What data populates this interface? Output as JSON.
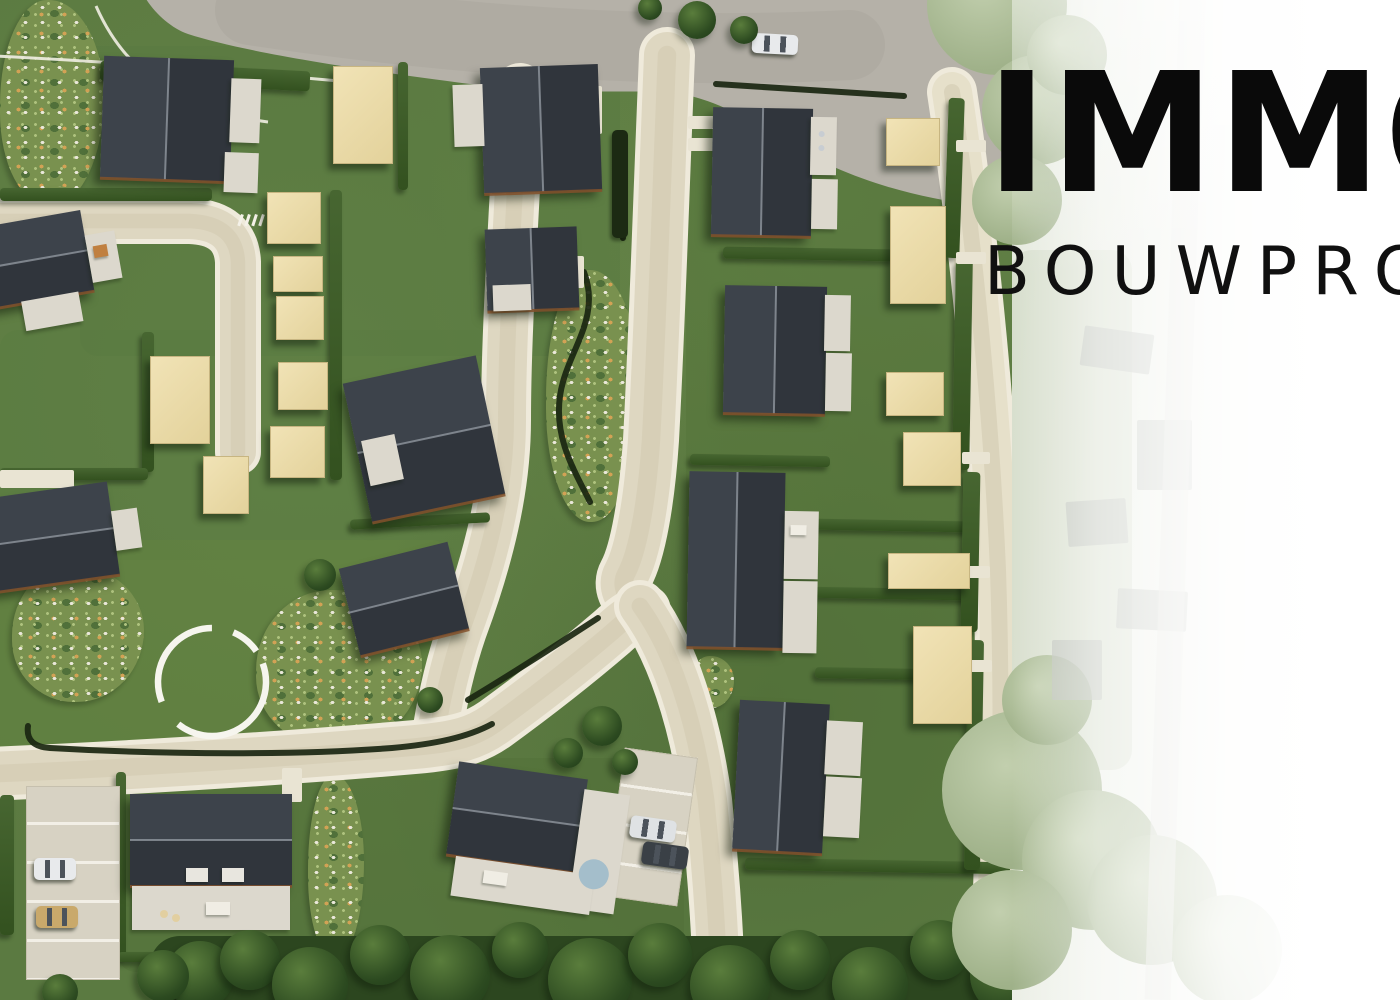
{
  "meta": {
    "description": "Aerial 3D masterplan render of a new-build housing development with roads, lawns, hedges, garages and a park, fading on the right into an aerial photo with the developer logo",
    "developer_logo_visible": true
  },
  "logo": {
    "line1_visible": "IMM",
    "line1_clipped_letter": "O",
    "line2_visible": "BOUWPR",
    "line2_clipped_letter": "O",
    "color": "#0a0a0a"
  },
  "palette": {
    "grass": "#5b7a41",
    "road_asphalt": "#b5b1a8",
    "road_beige": "#ded7c1",
    "road_edge": "#efeadb",
    "roof_dark_a": "#3d434b",
    "roof_dark_b": "#30353c",
    "facade_white": "#dcd8cd",
    "garage_beige": "#ecdcab",
    "hedge_green": "#3b5a2b",
    "hedge_dark": "#1c2a13",
    "forest": "#2c461f",
    "path_circle_white": "#f6f5ee",
    "spa_blue": "#a4becb",
    "fade_white": "#ffffff"
  },
  "scene": {
    "patches": [
      {
        "x": 80,
        "y": 46,
        "w": 540,
        "h": 310,
        "c": "#587740",
        "o": 0.4
      },
      {
        "x": 0,
        "y": 330,
        "w": 500,
        "h": 230,
        "c": "#5a7a42",
        "o": 0.35
      },
      {
        "x": 0,
        "y": 540,
        "w": 450,
        "h": 240,
        "c": "#64833f",
        "o": 0.5
      },
      {
        "x": 686,
        "y": 96,
        "w": 284,
        "h": 780,
        "c": "#55733a",
        "o": 0.45
      },
      {
        "x": 118,
        "y": 758,
        "w": 566,
        "h": 214,
        "c": "#4f6d38",
        "o": 0.4
      }
    ],
    "roads": {
      "top_fill": "M 140,-12 L 1014,-12 L 1014,205 C 985,207 958,203 933,198 C 878,187 828,168 783,140 C 743,115 704,94 664,92 C 629,90 560,95 470,84 C 330,66 238,50 188,34 C 168,27 149,8 140,-12 Z",
      "strokes": [
        {
          "n": "right-access-path",
          "d": "M 952,92 C 976,250 992,430 998,570 C 1003,720 1000,860 994,1005",
          "w": 40,
          "c": "#e6e0ca"
        },
        {
          "n": "cul-de-sac-west",
          "d": "M -12,221 L 190,221 Q 236,223 238,262 L 238,452",
          "w": 36,
          "c": "#ded7c1"
        },
        {
          "n": "street-north-south-west",
          "d": "M 520,88 C 514,220 506,330 506,420 C 506,490 488,560 462,630 C 450,665 442,700 436,740",
          "w": 40,
          "c": "#ded7c1"
        },
        {
          "n": "street-north-south-east",
          "d": "M 667,55 C 661,200 657,330 651,440 C 647,500 638,552 626,574 C 620,585 626,598 638,608",
          "w": 46,
          "c": "#ded7c1"
        },
        {
          "n": "loop-street",
          "d": "M -12,774 C 150,767 300,757 415,747 C 458,743 475,738 495,724 C 528,700 570,668 612,632 C 624,621 632,615 644,611",
          "w": 44,
          "c": "#ded7c1"
        },
        {
          "n": "street-southeast",
          "d": "M 640,606 C 672,650 695,720 706,800 C 713,865 718,935 720,1006",
          "w": 42,
          "c": "#ded7c1"
        }
      ],
      "dark_lines": [
        "M 28,726 C 26,740 34,747 50,748 C 170,755 300,755 392,748 C 436,744 468,737 492,724",
        "M 468,700 C 515,672 558,644 598,618",
        "M 584,272 C 602,320 566,352 560,396 C 554,438 574,470 590,502",
        "M 716,84 C 775,88 845,92 904,96",
        "M 619,134 L 623,238"
      ],
      "sidewalks": [
        "M -5,56 C 120,62 240,72 350,82",
        "M 96,6 C 118,56 152,86 200,104 C 228,114 252,120 268,122"
      ],
      "crosswalk": {
        "x": 241,
        "y": 214,
        "count": 4,
        "dx": 7
      }
    },
    "park_circle": {
      "cx": 212,
      "cy": 682,
      "r": 54,
      "dash": "140 28 105 22 30 14"
    },
    "houses": [
      {
        "n": "house-nw",
        "x": 102,
        "y": 58,
        "w": 130,
        "h": 122,
        "rot": 2,
        "split": "v",
        "parts": [
          [
            128,
            18,
            30,
            64
          ],
          [
            124,
            92,
            34,
            40
          ]
        ],
        "details": []
      },
      {
        "n": "house-n-mid",
        "x": 482,
        "y": 66,
        "w": 118,
        "h": 126,
        "rot": -2,
        "split": "v",
        "parts": [
          [
            -28,
            16,
            30,
            62
          ]
        ],
        "details": []
      },
      {
        "n": "house-small-mid",
        "x": 486,
        "y": 228,
        "w": 92,
        "h": 82,
        "rot": -2,
        "split": "v",
        "parts": [
          [
            6,
            56,
            38,
            26
          ]
        ],
        "details": []
      },
      {
        "n": "house-west-edge-1",
        "x": -12,
        "y": 218,
        "w": 100,
        "h": 82,
        "rot": -10,
        "split": "h",
        "parts": [
          [
            100,
            26,
            30,
            48
          ],
          [
            26,
            80,
            58,
            30
          ]
        ],
        "details": [
          {
            "t": "rect",
            "x": 106,
            "y": 38,
            "w": 14,
            "h": 12,
            "c": "#c08040"
          }
        ]
      },
      {
        "n": "house-west-edge-2",
        "x": -14,
        "y": 490,
        "w": 128,
        "h": 94,
        "rot": -8,
        "split": "h",
        "parts": [
          [
            128,
            30,
            26,
            40
          ]
        ],
        "details": []
      },
      {
        "n": "house-center",
        "x": 356,
        "y": 368,
        "w": 136,
        "h": 142,
        "rot": -12,
        "split": "h",
        "parts": [
          [
            6,
            60,
            34,
            46
          ]
        ],
        "details": []
      },
      {
        "n": "house-park",
        "x": 348,
        "y": 554,
        "w": 112,
        "h": 90,
        "rot": -14,
        "split": "h",
        "parts": [],
        "details": []
      },
      {
        "n": "house-sw-semi",
        "x": 130,
        "y": 794,
        "w": 162,
        "h": 92,
        "rot": 0,
        "split": "h",
        "parts": [
          [
            2,
            92,
            158,
            44
          ]
        ],
        "details": [
          {
            "t": "rect",
            "x": 56,
            "y": 74,
            "w": 22,
            "h": 14,
            "c": "#e8e6df"
          },
          {
            "t": "rect",
            "x": 92,
            "y": 74,
            "w": 22,
            "h": 14,
            "c": "#e8e6df"
          },
          {
            "t": "rect",
            "x": 76,
            "y": 108,
            "w": 24,
            "h": 13,
            "c": "#f0ede4"
          },
          {
            "t": "circle",
            "x": 30,
            "y": 116,
            "d": 8,
            "c": "#e2cfa0"
          },
          {
            "t": "circle",
            "x": 42,
            "y": 120,
            "d": 8,
            "c": "#e2cfa0"
          }
        ]
      },
      {
        "n": "house-s-semi",
        "x": 452,
        "y": 770,
        "w": 130,
        "h": 94,
        "rot": 8,
        "split": "h",
        "parts": [
          [
            128,
            10,
            46,
            120
          ],
          [
            10,
            94,
            140,
            40
          ]
        ],
        "details": [
          {
            "t": "circle",
            "x": 134,
            "y": 78,
            "d": 30,
            "c": "#a4becb"
          },
          {
            "t": "rect",
            "x": 40,
            "y": 104,
            "w": 24,
            "h": 13,
            "c": "#f0ede4"
          }
        ]
      },
      {
        "n": "house-e1",
        "x": 712,
        "y": 108,
        "w": 100,
        "h": 128,
        "rot": 1,
        "split": "v",
        "parts": [
          [
            98,
            8,
            26,
            58
          ],
          [
            100,
            70,
            26,
            50
          ]
        ],
        "details": [
          {
            "t": "circle",
            "x": 106,
            "y": 22,
            "d": 6,
            "c": "#c8cdd2"
          },
          {
            "t": "circle",
            "x": 106,
            "y": 36,
            "d": 6,
            "c": "#c8cdd2"
          }
        ]
      },
      {
        "n": "house-e2",
        "x": 724,
        "y": 286,
        "w": 102,
        "h": 128,
        "rot": 1,
        "split": "v",
        "parts": [
          [
            100,
            8,
            26,
            56
          ],
          [
            102,
            66,
            26,
            58
          ]
        ],
        "details": []
      },
      {
        "n": "house-e3",
        "x": 688,
        "y": 472,
        "w": 96,
        "h": 176,
        "rot": 1,
        "split": "v",
        "parts": [
          [
            96,
            38,
            34,
            68
          ],
          [
            96,
            108,
            34,
            72
          ]
        ],
        "details": [
          {
            "t": "rect",
            "x": 102,
            "y": 52,
            "w": 16,
            "h": 10,
            "c": "#f0ede4"
          }
        ]
      },
      {
        "n": "house-e4",
        "x": 736,
        "y": 702,
        "w": 90,
        "h": 150,
        "rot": 3,
        "split": "v",
        "parts": [
          [
            88,
            16,
            36,
            54
          ],
          [
            90,
            72,
            36,
            60
          ]
        ],
        "details": []
      }
    ],
    "garages": [
      {
        "n": "shed-n",
        "x": 333,
        "y": 66,
        "w": 58,
        "h": 96
      },
      {
        "n": "shed-mid-a",
        "x": 150,
        "y": 356,
        "w": 58,
        "h": 86
      },
      {
        "n": "shed-mid-b",
        "x": 203,
        "y": 456,
        "w": 44,
        "h": 56
      },
      {
        "n": "shed-row-1",
        "x": 267,
        "y": 192,
        "w": 52,
        "h": 50
      },
      {
        "n": "shed-row-2",
        "x": 273,
        "y": 256,
        "w": 48,
        "h": 34
      },
      {
        "n": "shed-row-3",
        "x": 276,
        "y": 296,
        "w": 46,
        "h": 42
      },
      {
        "n": "shed-row-4",
        "x": 278,
        "y": 362,
        "w": 48,
        "h": 46
      },
      {
        "n": "shed-row-5",
        "x": 270,
        "y": 426,
        "w": 53,
        "h": 50
      },
      {
        "n": "garage-e1",
        "x": 886,
        "y": 118,
        "w": 52,
        "h": 46
      },
      {
        "n": "garage-e2",
        "x": 890,
        "y": 206,
        "w": 54,
        "h": 96
      },
      {
        "n": "garage-e3",
        "x": 886,
        "y": 372,
        "w": 56,
        "h": 42
      },
      {
        "n": "garage-e4",
        "x": 903,
        "y": 432,
        "w": 56,
        "h": 52
      },
      {
        "n": "garage-e5",
        "x": 888,
        "y": 553,
        "w": 80,
        "h": 34
      },
      {
        "n": "garage-e6",
        "x": 913,
        "y": 626,
        "w": 57,
        "h": 96
      }
    ],
    "hedges": [
      [
        0,
        188,
        212,
        13,
        0
      ],
      [
        100,
        66,
        210,
        20,
        3
      ],
      [
        398,
        62,
        10,
        128,
        0
      ],
      [
        330,
        190,
        12,
        290,
        0
      ],
      [
        142,
        332,
        12,
        140,
        0
      ],
      [
        0,
        468,
        148,
        12,
        0
      ],
      [
        350,
        516,
        140,
        10,
        -3
      ],
      [
        116,
        772,
        10,
        186,
        0
      ],
      [
        118,
        952,
        186,
        10,
        0
      ],
      [
        0,
        795,
        14,
        140,
        0
      ],
      [
        723,
        248,
        172,
        12,
        1
      ],
      [
        690,
        455,
        140,
        11,
        1
      ],
      [
        808,
        520,
        162,
        11,
        1
      ],
      [
        800,
        588,
        170,
        11,
        1
      ],
      [
        815,
        668,
        106,
        11,
        1
      ],
      [
        745,
        860,
        265,
        12,
        1
      ],
      [
        946,
        98,
        16,
        160,
        2
      ],
      [
        954,
        260,
        17,
        210,
        1
      ],
      [
        962,
        472,
        17,
        160,
        1
      ],
      [
        966,
        640,
        16,
        230,
        1
      ]
    ],
    "dark_hedges": [
      [
        612,
        130,
        16,
        108,
        0
      ]
    ],
    "flowerbeds": [
      {
        "n": "bed-park-west",
        "x": 12,
        "y": 566,
        "w": 132,
        "h": 136
      },
      {
        "n": "bed-park-east",
        "x": 256,
        "y": 590,
        "w": 166,
        "h": 158
      },
      {
        "n": "bed-center-strip",
        "x": 546,
        "y": 270,
        "w": 94,
        "h": 252
      },
      {
        "n": "bed-sw-garden",
        "x": 308,
        "y": 775,
        "w": 56,
        "h": 184
      },
      {
        "n": "bed-junction",
        "x": 690,
        "y": 656,
        "w": 44,
        "h": 52
      },
      {
        "n": "bed-nw-corner",
        "x": 0,
        "y": 0,
        "w": 104,
        "h": 206
      },
      {
        "n": "bed-culdesac",
        "x": 38,
        "y": 186,
        "w": 42,
        "h": 36
      }
    ],
    "trees": [
      [
        697,
        20,
        19
      ],
      [
        744,
        30,
        14
      ],
      [
        650,
        8,
        12
      ],
      [
        602,
        726,
        20
      ],
      [
        568,
        753,
        15
      ],
      [
        625,
        762,
        13
      ],
      [
        430,
        700,
        13
      ],
      [
        320,
        575,
        16
      ],
      [
        200,
        975,
        34
      ],
      [
        250,
        960,
        30
      ],
      [
        310,
        985,
        38
      ],
      [
        380,
        955,
        30
      ],
      [
        450,
        975,
        40
      ],
      [
        520,
        950,
        28
      ],
      [
        590,
        980,
        42
      ],
      [
        660,
        955,
        32
      ],
      [
        730,
        985,
        40
      ],
      [
        800,
        960,
        30
      ],
      [
        870,
        985,
        38
      ],
      [
        940,
        950,
        30
      ],
      [
        1010,
        975,
        40
      ],
      [
        1070,
        950,
        30
      ],
      [
        163,
        976,
        26
      ],
      [
        60,
        992,
        18
      ]
    ],
    "forest_band": {
      "x": 150,
      "y": 936,
      "w": 940,
      "h": 70,
      "c": "#2c461f"
    },
    "parking_lots": [
      {
        "n": "parking-sw",
        "x": 26,
        "y": 786,
        "w": 94,
        "h": 194,
        "rot": 0,
        "lines": true
      },
      {
        "n": "driveway-s-semi",
        "x": 614,
        "y": 752,
        "w": 74,
        "h": 150,
        "rot": 8,
        "lines": true
      }
    ],
    "white_patches": [
      [
        688,
        116,
        26,
        13
      ],
      [
        688,
        138,
        26,
        13
      ],
      [
        956,
        140,
        30,
        12
      ],
      [
        956,
        252,
        30,
        12
      ],
      [
        962,
        452,
        28,
        12
      ],
      [
        956,
        566,
        34,
        12
      ],
      [
        962,
        660,
        30,
        12
      ],
      [
        282,
        768,
        20,
        34
      ],
      [
        0,
        470,
        74,
        18
      ],
      [
        548,
        86,
        54,
        48
      ],
      [
        552,
        256,
        32,
        32
      ]
    ],
    "cars": [
      {
        "n": "car-top-road",
        "x": 752,
        "y": 34,
        "w": 46,
        "h": 20,
        "rot": 3,
        "c": "#e8eaec"
      },
      {
        "n": "car-parking-white",
        "x": 34,
        "y": 858,
        "w": 42,
        "h": 22,
        "rot": 0,
        "c": "#e8eaec"
      },
      {
        "n": "car-parking-tan",
        "x": 36,
        "y": 906,
        "w": 42,
        "h": 22,
        "rot": 0,
        "c": "#c9a96b"
      },
      {
        "n": "car-driveway-light",
        "x": 630,
        "y": 818,
        "w": 46,
        "h": 22,
        "rot": 8,
        "c": "#dfe2e4"
      },
      {
        "n": "car-driveway-dark",
        "x": 642,
        "y": 844,
        "w": 46,
        "h": 23,
        "rot": 8,
        "c": "#3a4046"
      }
    ],
    "faded_zone": {
      "left": 1012,
      "width": 388,
      "blobs": [
        [
          -15,
          5,
          70
        ],
        [
          25,
          110,
          55
        ],
        [
          5,
          200,
          45
        ],
        [
          55,
          55,
          40
        ],
        [
          10,
          790,
          80
        ],
        [
          80,
          860,
          70
        ],
        [
          0,
          930,
          60
        ],
        [
          140,
          900,
          65
        ],
        [
          215,
          950,
          55
        ],
        [
          35,
          700,
          45
        ]
      ],
      "band": {
        "x": 0,
        "y": 250,
        "w": 120,
        "h": 520
      },
      "roofs": [
        [
          70,
          330,
          70,
          40,
          8
        ],
        [
          125,
          420,
          55,
          70,
          0
        ],
        [
          55,
          500,
          60,
          45,
          -4
        ],
        [
          105,
          590,
          70,
          40,
          3
        ],
        [
          40,
          640,
          50,
          60,
          0
        ]
      ],
      "faint_road": {
        "x": 150,
        "y": 0,
        "w": 26,
        "h": 1000,
        "rot": 2
      }
    }
  }
}
